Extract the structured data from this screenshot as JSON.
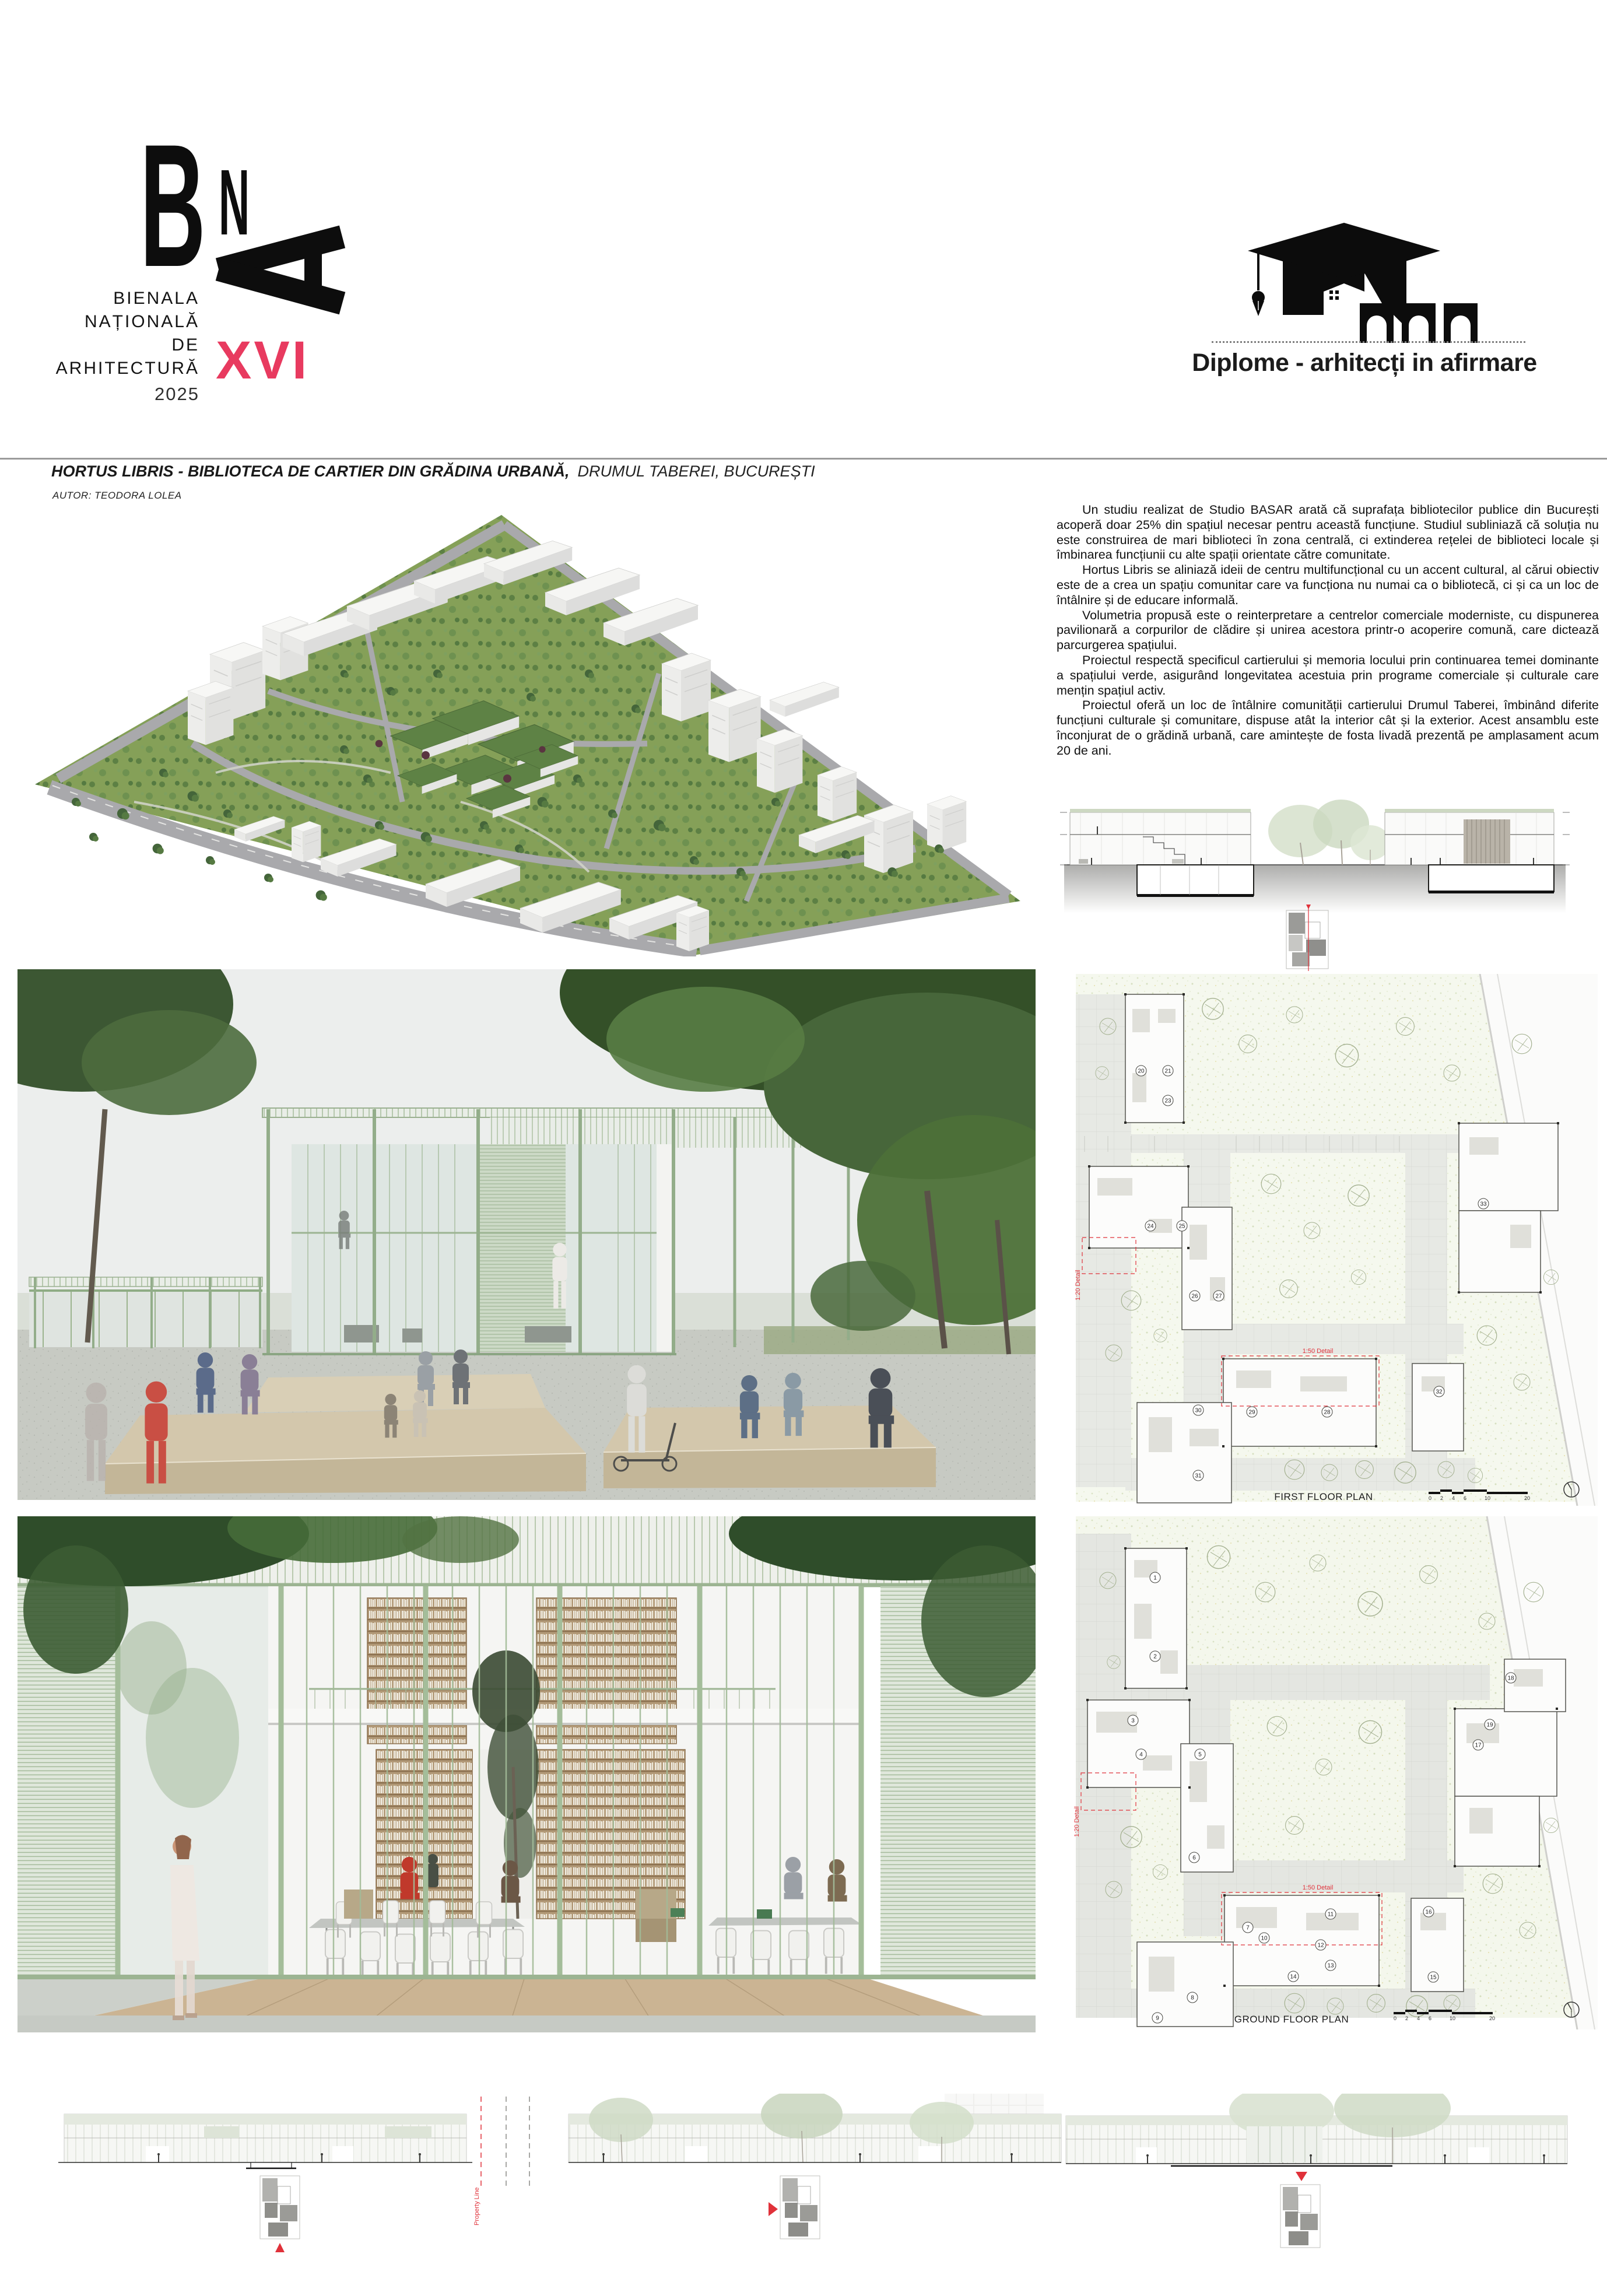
{
  "poster": {
    "bna": {
      "letter_b": "B",
      "letter_n": "N",
      "letter_a": "A",
      "lines": [
        "BIENALA",
        "NAȚIONALĂ",
        "DE",
        "ARHITECTURĂ"
      ],
      "year": "2025",
      "edition": "XVI"
    },
    "program": {
      "label": "Diplome - arhitecți in afirmare"
    },
    "title": {
      "project": "HORTUS LIBRIS",
      "subtitle": "- BIBLIOTECA DE CARTIER DIN GRĂDINA URBANĂ,",
      "location": "DRUMUL TABEREI, BUCUREȘTI",
      "author": "AUTOR: TEODORA LOLEA"
    },
    "intro": {
      "paragraphs": [
        "Un studiu realizat de Studio BASAR arată că suprafața bibliotecilor publice din București acoperă doar 25% din spațiul necesar pentru această funcțiune. Studiul subliniază că soluția nu este construirea de mari biblioteci în zona centrală, ci extinderea rețelei de biblioteci locale și îmbinarea funcțiunii cu alte spații orientate către comunitate.",
        "Hortus Libris se aliniază ideii de centru multifuncțional cu un accent cultural, al cărui obiectiv este de a crea un spațiu comunitar care va funcționa nu numai ca o bibliotecă, ci și ca un loc de întâlnire și de educare informală.",
        "Volumetria propusă este o reinterpretare a centrelor comerciale moderniste, cu dispunerea pavilionară a corpurilor de clădire și unirea acestora printr-o acoperire comună, care dictează parcurgerea spațiului.",
        "Proiectul respectă specificul cartierului și memoria locului prin continuarea temei dominante a spațiului verde, asigurând longevitatea acestuia prin programe comerciale și culturale care mențin spațiul activ.",
        "Proiectul oferă un loc de întâlnire comunității cartierului Drumul Taberei, îmbinând diferite funcțiuni culturale și comunitare, dispuse atât la interior cât și la exterior. Acest ansamblu este înconjurat de o grădină urbană, care amintește de fosta livadă prezentă pe amplasament acum 20 de ani."
      ]
    },
    "drawings": {
      "first_floor": {
        "label": "FIRST FLOOR PLAN",
        "rooms": [
          "20",
          "21",
          "23",
          "24",
          "25",
          "26",
          "27",
          "28",
          "29",
          "30",
          "31",
          "32",
          "33"
        ],
        "detail_20": "1:20 Detail",
        "detail_50": "1:50 Detail"
      },
      "ground_floor": {
        "label": "GROUND FLOOR PLAN",
        "rooms": [
          "1",
          "2",
          "3",
          "4",
          "5",
          "6",
          "7",
          "8",
          "9",
          "10",
          "11",
          "12",
          "13",
          "14",
          "15",
          "16",
          "17",
          "18",
          "19"
        ],
        "detail_20": "1:20 Detail",
        "detail_50": "1:50 Detail"
      },
      "scale_labels": [
        "0",
        "2",
        "4",
        "6",
        "10",
        "20"
      ],
      "property_line": "Property Line"
    },
    "colors": {
      "accent": "#e83a5f",
      "marker_red": "#e0313a",
      "sage_frame": "#9db794",
      "foliage": "#49683b"
    }
  }
}
